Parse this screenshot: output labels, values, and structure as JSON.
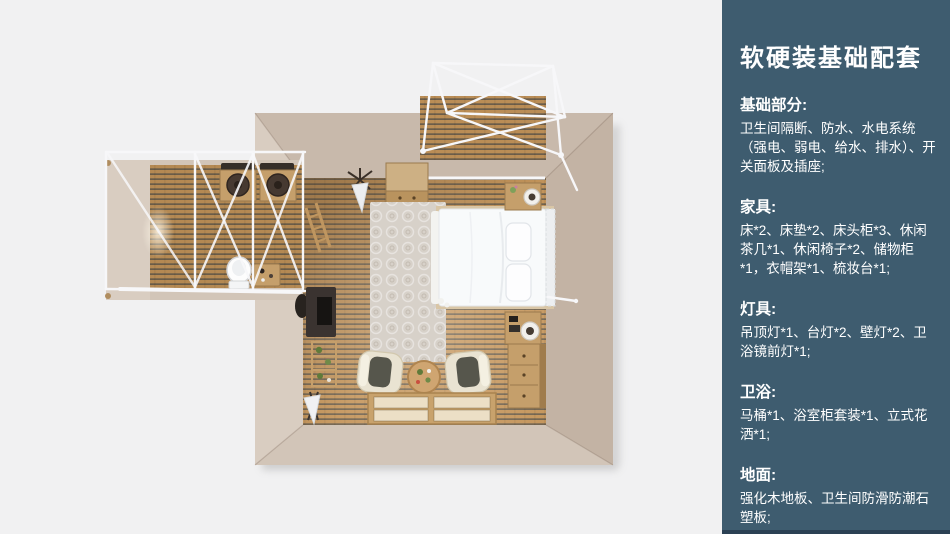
{
  "colors": {
    "canvas-bg": "#f1f1f2",
    "panel-bg": "#3e5c6f",
    "panel-footer": "#2b4154",
    "panel-text": "#ffffff",
    "wall": "#d2c5b8",
    "wall-light": "#d9cdc1",
    "wall-dark": "#c3b3a4",
    "wall-top": "#c8b9ab",
    "wood": "#c4955b",
    "wood-dark": "#5e564b",
    "frame-white": "#f7f7f9",
    "rug": "#d7d1c9",
    "bed-white": "#f8fafb",
    "furn-wood": "#c59f6b",
    "furn-wood-dark": "#9a7a4e",
    "desk-dark": "#3a3330",
    "seat-dark": "#56564c",
    "chair-cream": "#e9e3d2",
    "mat-cream": "#ecdfc6",
    "basin-dark": "#463931",
    "plant-green": "#5f7a3a"
  },
  "panel": {
    "title": "软硬装基础配套",
    "sections": [
      {
        "heading": "基础部分:",
        "body": "卫生间隔断、防水、水电系统（强电、弱电、给水、排水）、开关面板及插座;"
      },
      {
        "heading": "家具:",
        "body": "床*2、床垫*2、床头柜*3、休闲茶几*1、休闲椅子*2、储物柜*1，衣帽架*1、梳妆台*1;"
      },
      {
        "heading": "灯具:",
        "body": "吊顶灯*1、台灯*2、壁灯*2、卫浴镜前灯*1;"
      },
      {
        "heading": "卫浴:",
        "body": "马桶*1、浴室柜套装*1、立式花洒*1;"
      },
      {
        "heading": "地面:",
        "body": "强化木地板、卫生间防滑防潮石塑板;"
      }
    ]
  }
}
